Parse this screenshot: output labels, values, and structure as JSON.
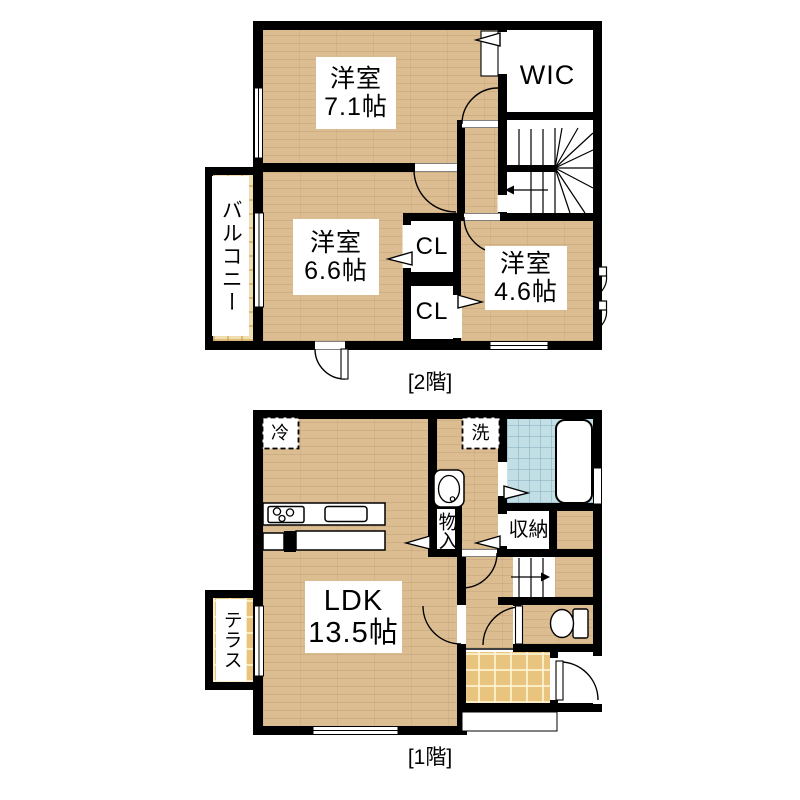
{
  "colors": {
    "wall": "#000000",
    "wood_floor": "#dcbd92",
    "balcony_tile": "#f0ddb0",
    "entry_tile": "#e9c47f",
    "bath_tile": "#c2dfe6",
    "background": "#ffffff"
  },
  "floor2": {
    "caption": "[2階]",
    "rooms": {
      "bedroom71": {
        "name": "洋室",
        "size": "7.1帖"
      },
      "bedroom66": {
        "name": "洋室",
        "size": "6.6帖"
      },
      "bedroom46": {
        "name": "洋室",
        "size": "4.6帖"
      },
      "wic": {
        "name": "WIC"
      },
      "closet1": {
        "name": "CL"
      },
      "closet2": {
        "name": "CL"
      },
      "balcony": {
        "name": "バルコニー"
      }
    }
  },
  "floor1": {
    "caption": "[1階]",
    "rooms": {
      "ldk": {
        "name": "LDK",
        "size": "13.5帖"
      },
      "storage_hall": {
        "name": "物入"
      },
      "storage_wash": {
        "name": "収納"
      },
      "terrace": {
        "name": "テラス"
      },
      "fridge": {
        "name": "冷"
      },
      "laundry": {
        "name": "洗"
      }
    }
  }
}
